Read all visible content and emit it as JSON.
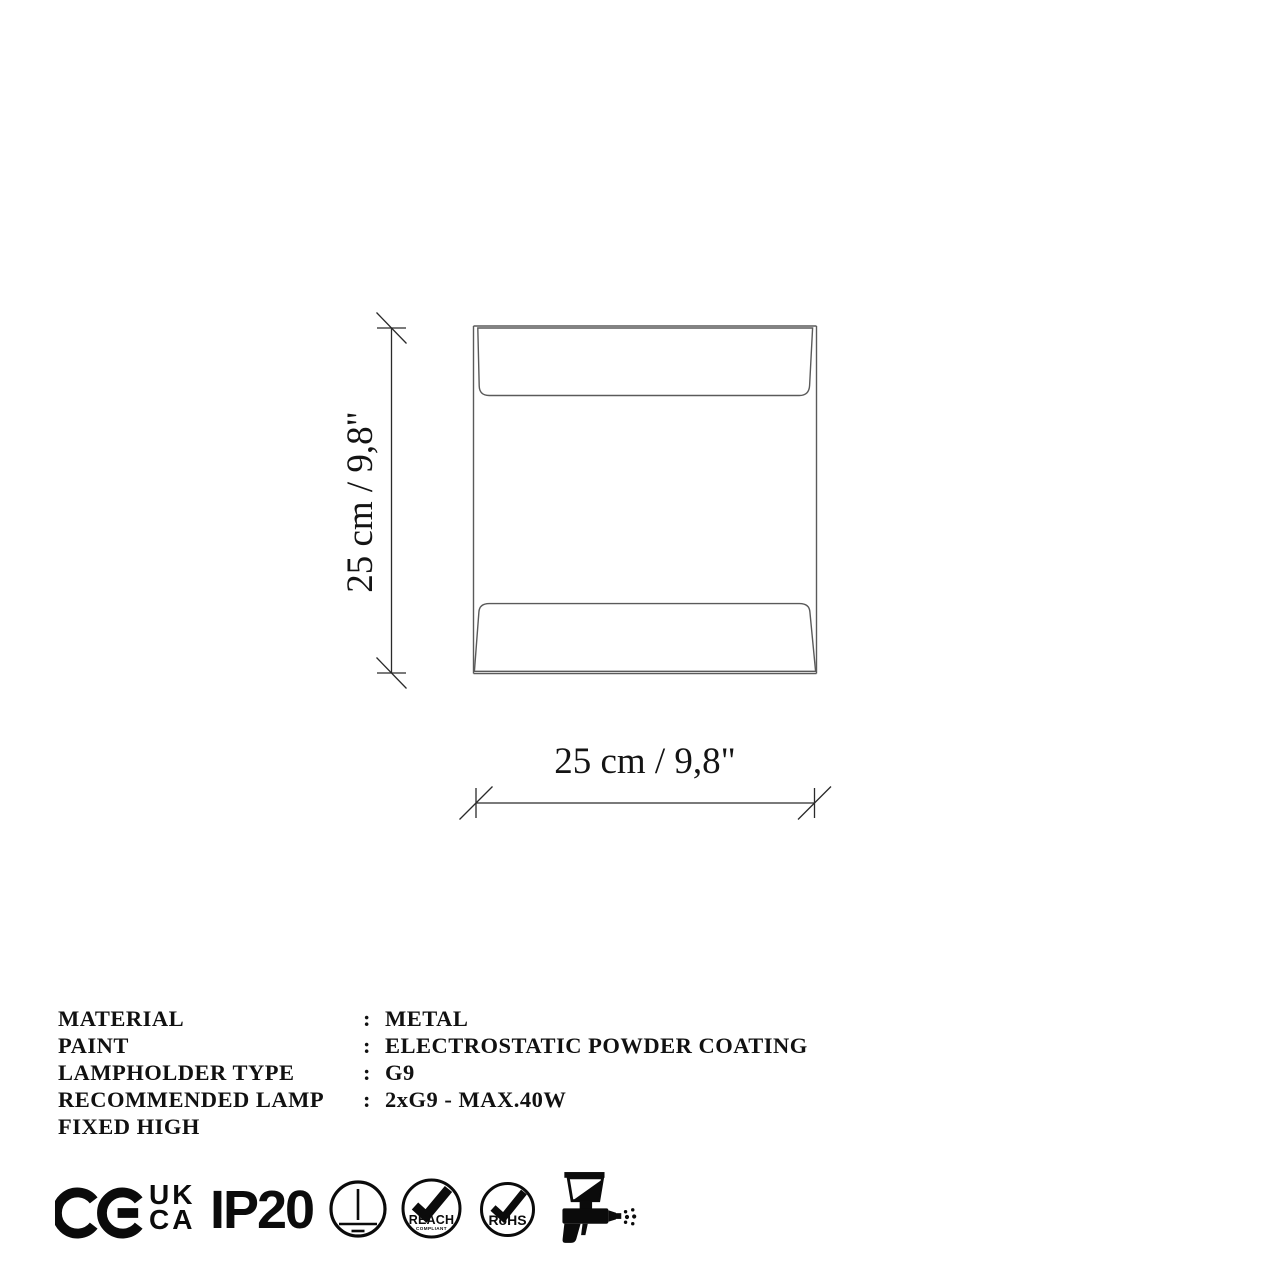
{
  "drawing": {
    "type": "wall-lamp front view technical drawing",
    "height_label": "25 cm / 9,8\"",
    "width_label": "25 cm / 9,8\""
  },
  "specs": {
    "rows": [
      {
        "label": "MATERIAL",
        "colon": ":",
        "value": "METAL"
      },
      {
        "label": "PAINT",
        "colon": ":",
        "value": "ELECTROSTATIC POWDER COATING"
      },
      {
        "label": "LAMPHOLDER TYPE",
        "colon": ":",
        "value": "G9"
      },
      {
        "label": "RECOMMENDED LAMP",
        "colon": ":",
        "value": "2xG9 - MAX.40W"
      },
      {
        "label": "FIXED HIGH",
        "colon": "",
        "value": ""
      }
    ]
  },
  "certifications": {
    "ce": "CE marking",
    "ukca_line1": "UK",
    "ukca_line2": "CA",
    "ip_rating": "IP20",
    "grounding": "protective earth class I",
    "reach_label": "REACH",
    "reach_sub": "COMPLIANT",
    "rohs_label": "RoHS",
    "spray": "electrostatic spray painted"
  },
  "colors": {
    "background": "#ffffff",
    "drawing_line": "#5a5a5a",
    "dimension_line": "#2a2a2a",
    "ink": "#111111",
    "icon_black": "#0b0b0b"
  }
}
